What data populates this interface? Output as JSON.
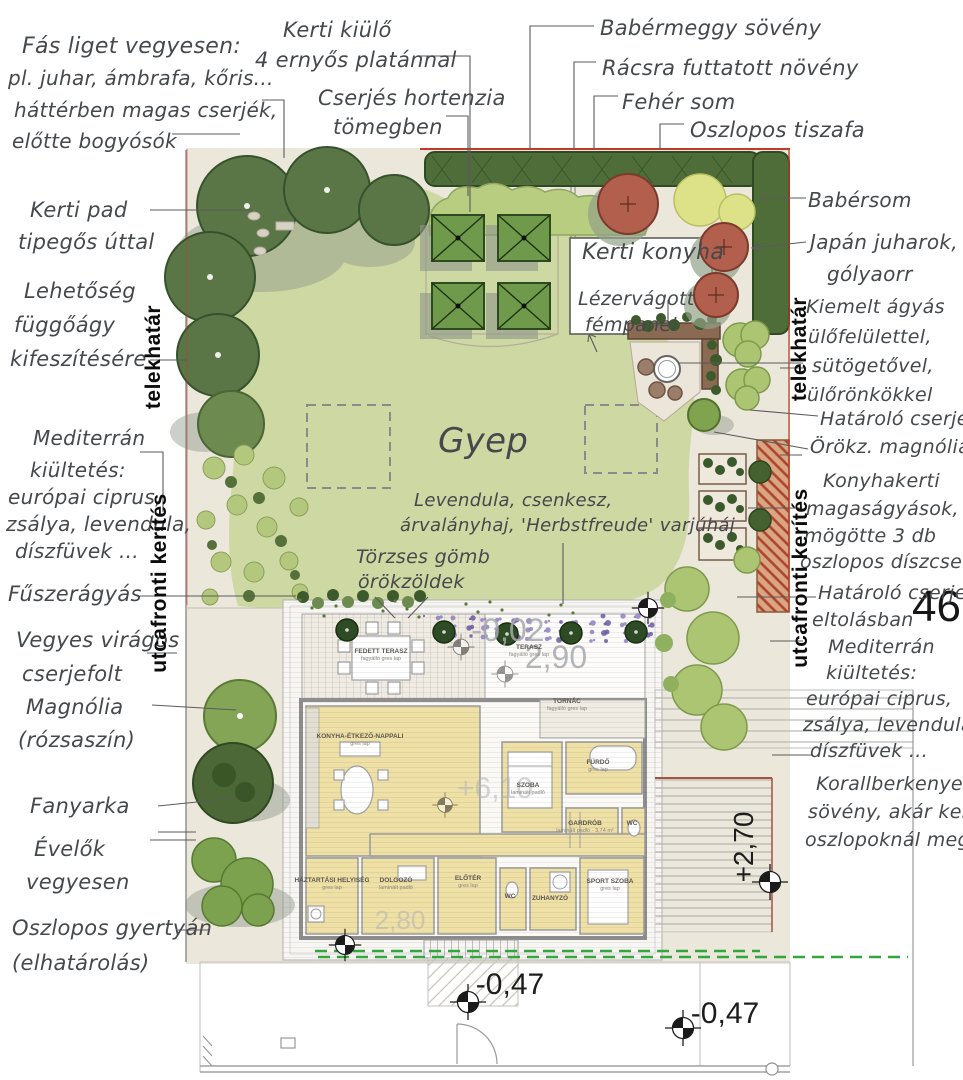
{
  "plot_number": "46",
  "palette": {
    "lawn": "#cdd8a2",
    "ground": "#ece7db",
    "hedge_dark": "#4f6d39",
    "shrub_light": "#abc573",
    "tree_dark": "#5b7646",
    "japanese_maple": "#b2604d",
    "boundary_red": "#c0392b",
    "room_yellow": "#efe0a5",
    "lavender": "#8d7fc0",
    "handwriting": "#45494c",
    "dashed_green": "#33a63c"
  },
  "handwritten_labels": [
    {
      "t": "Fás liget vegyesen:",
      "x": 22,
      "y": 36,
      "fs": 22
    },
    {
      "t": "pl. juhar, ámbrafa, kőris...",
      "x": 8,
      "y": 68,
      "fs": 20
    },
    {
      "t": "háttérben magas cserjék,",
      "x": 14,
      "y": 100,
      "fs": 20
    },
    {
      "t": "előtte bogyósók",
      "x": 12,
      "y": 131,
      "fs": 20
    },
    {
      "t": "Kerti pad",
      "x": 30,
      "y": 200,
      "fs": 21
    },
    {
      "t": "tipegős úttal",
      "x": 18,
      "y": 232,
      "fs": 21
    },
    {
      "t": "Lehetőség",
      "x": 24,
      "y": 281,
      "fs": 21
    },
    {
      "t": "függőágy",
      "x": 14,
      "y": 315,
      "fs": 21
    },
    {
      "t": "kifeszítésére",
      "x": 10,
      "y": 349,
      "fs": 21
    },
    {
      "t": "Mediterrán",
      "x": 33,
      "y": 428,
      "fs": 20
    },
    {
      "t": "kiültetés:",
      "x": 30,
      "y": 460,
      "fs": 20
    },
    {
      "t": "európai ciprus,",
      "x": 8,
      "y": 487,
      "fs": 20
    },
    {
      "t": "zsálya, levendula,",
      "x": 6,
      "y": 514,
      "fs": 20
    },
    {
      "t": "díszfüvek ...",
      "x": 15,
      "y": 541,
      "fs": 20
    },
    {
      "t": "Fűszerágyás",
      "x": 8,
      "y": 584,
      "fs": 21
    },
    {
      "t": "Vegyes virágos",
      "x": 16,
      "y": 630,
      "fs": 21
    },
    {
      "t": "cserjefolt",
      "x": 22,
      "y": 664,
      "fs": 21
    },
    {
      "t": "Magnólia",
      "x": 26,
      "y": 697,
      "fs": 21
    },
    {
      "t": "(rózsaszín)",
      "x": 18,
      "y": 730,
      "fs": 21
    },
    {
      "t": "Fanyarka",
      "x": 30,
      "y": 796,
      "fs": 21
    },
    {
      "t": "Évelők",
      "x": 34,
      "y": 839,
      "fs": 21
    },
    {
      "t": "vegyesen",
      "x": 26,
      "y": 872,
      "fs": 21
    },
    {
      "t": "Oszlopos gyertyán",
      "x": 12,
      "y": 918,
      "fs": 21
    },
    {
      "t": "(elhatárolás)",
      "x": 12,
      "y": 953,
      "fs": 21
    },
    {
      "t": "Kerti kiülő",
      "x": 283,
      "y": 20,
      "fs": 21
    },
    {
      "t": "4 ernyős platánnal",
      "x": 255,
      "y": 50,
      "fs": 21
    },
    {
      "t": "Cserjés hortenzia",
      "x": 318,
      "y": 88,
      "fs": 21
    },
    {
      "t": "tömegben",
      "x": 333,
      "y": 117,
      "fs": 21
    },
    {
      "t": "Babérmeggy sövény",
      "x": 600,
      "y": 18,
      "fs": 21
    },
    {
      "t": "Rácsra futtatott növény",
      "x": 602,
      "y": 58,
      "fs": 21
    },
    {
      "t": "Fehér som",
      "x": 622,
      "y": 92,
      "fs": 21
    },
    {
      "t": "Oszlopos tiszafa",
      "x": 690,
      "y": 120,
      "fs": 21
    },
    {
      "t": "Babérsom",
      "x": 808,
      "y": 190,
      "fs": 20
    },
    {
      "t": "Japán juharok,",
      "x": 810,
      "y": 232,
      "fs": 20
    },
    {
      "t": "gólyaorr",
      "x": 827,
      "y": 264,
      "fs": 20
    },
    {
      "t": "Kiemelt ágyás",
      "x": 806,
      "y": 298,
      "fs": 19
    },
    {
      "t": "ülőfelülettel,",
      "x": 808,
      "y": 328,
      "fs": 19
    },
    {
      "t": "sütögetővel,",
      "x": 812,
      "y": 357,
      "fs": 19
    },
    {
      "t": "ülőrönkökkel",
      "x": 807,
      "y": 386,
      "fs": 19
    },
    {
      "t": "Határoló cserje",
      "x": 820,
      "y": 410,
      "fs": 19
    },
    {
      "t": "Örökz. magnólia",
      "x": 810,
      "y": 438,
      "fs": 19
    },
    {
      "t": "Konyhakerti",
      "x": 823,
      "y": 472,
      "fs": 19
    },
    {
      "t": "magaságyások,",
      "x": 806,
      "y": 500,
      "fs": 19
    },
    {
      "t": "mögötte 3 db",
      "x": 804,
      "y": 527,
      "fs": 19
    },
    {
      "t": "oszlopos díszcser.",
      "x": 800,
      "y": 553,
      "fs": 19
    },
    {
      "t": "Határoló cserje",
      "x": 818,
      "y": 584,
      "fs": 19
    },
    {
      "t": "eltolásban",
      "x": 812,
      "y": 611,
      "fs": 19
    },
    {
      "t": "Mediterrán",
      "x": 828,
      "y": 638,
      "fs": 19
    },
    {
      "t": "kiültetés:",
      "x": 826,
      "y": 664,
      "fs": 19
    },
    {
      "t": "európai ciprus,",
      "x": 806,
      "y": 690,
      "fs": 19
    },
    {
      "t": "zsálya, levendula,",
      "x": 803,
      "y": 716,
      "fs": 19
    },
    {
      "t": "díszfüvek ...",
      "x": 810,
      "y": 742,
      "fs": 19
    },
    {
      "t": "Korallberkenye",
      "x": 816,
      "y": 775,
      "fs": 19
    },
    {
      "t": "sövény, akár kerítés-",
      "x": 808,
      "y": 803,
      "fs": 19
    },
    {
      "t": "oszlopoknál megtörve",
      "x": 805,
      "y": 831,
      "fs": 19
    },
    {
      "t": "Kerti konyha",
      "x": 582,
      "y": 242,
      "fs": 22
    },
    {
      "t": "Lézervágott",
      "x": 578,
      "y": 290,
      "fs": 19
    },
    {
      "t": "fémpanel",
      "x": 585,
      "y": 316,
      "fs": 19
    },
    {
      "t": "Gyep",
      "x": 438,
      "y": 424,
      "fs": 34
    },
    {
      "t": "Levendula, csenkesz,",
      "x": 414,
      "y": 492,
      "fs": 18
    },
    {
      "t": "árvalányhaj, 'Herbstfreude' varjúháj",
      "x": 400,
      "y": 517,
      "fs": 18
    },
    {
      "t": "Törzses gömb",
      "x": 356,
      "y": 548,
      "fs": 19
    },
    {
      "t": "örökzöldek",
      "x": 358,
      "y": 573,
      "fs": 19
    }
  ],
  "boundary_labels": [
    {
      "t": "telekhatár",
      "x": 154,
      "y": 357
    },
    {
      "t": "utcafronti kerítés",
      "x": 160,
      "y": 583
    },
    {
      "t": "telekhatár",
      "x": 800,
      "y": 349
    },
    {
      "t": "utcafronti kerítés",
      "x": 801,
      "y": 578
    }
  ],
  "elevations": [
    {
      "t": "-0,02",
      "x": 508,
      "y": 630,
      "fs": 32,
      "s": "faded"
    },
    {
      "t": "2,90",
      "x": 556,
      "y": 657,
      "fs": 32,
      "s": "faded"
    },
    {
      "t": "+6,10",
      "x": 495,
      "y": 789,
      "fs": 30,
      "s": "faded2"
    },
    {
      "t": "2,80",
      "x": 400,
      "y": 920,
      "fs": 26,
      "s": "faded2"
    },
    {
      "t": "+2,70",
      "x": 744,
      "y": 847,
      "fs": 28,
      "s": "dark",
      "rot": -90
    },
    {
      "t": "-0,47",
      "x": 510,
      "y": 985,
      "fs": 30,
      "s": "dark"
    },
    {
      "t": "-0,47",
      "x": 725,
      "y": 1014,
      "fs": 30,
      "s": "dark"
    }
  ],
  "room_labels": [
    {
      "t": "FEDETT TERASZ",
      "s": "fagyálló gres lap",
      "x": 381,
      "y": 655
    },
    {
      "t": "TERASZ",
      "s": "fagyálló gres lap",
      "x": 529,
      "y": 651
    },
    {
      "t": "TORNÁC",
      "s": "fagyálló gres lap",
      "x": 567,
      "y": 705
    },
    {
      "t": "KONYHA-ÉTKEZŐ-NAPPALI",
      "s": "gres lap",
      "x": 360,
      "y": 740
    },
    {
      "t": "SZOBA",
      "s": "laminált padló",
      "x": 528,
      "y": 789
    },
    {
      "t": "FÜRDŐ",
      "s": "gres lap",
      "x": 598,
      "y": 766
    },
    {
      "t": "GARDRÓB",
      "s": "laminált padló · 3,74 m²",
      "x": 585,
      "y": 827
    },
    {
      "t": "WC",
      "s": "",
      "x": 632,
      "y": 824
    },
    {
      "t": "HÁZTARTÁSI HELYISÉG",
      "s": "gres lap",
      "x": 332,
      "y": 884
    },
    {
      "t": "DOLGOZÓ",
      "s": "laminált padló",
      "x": 396,
      "y": 884
    },
    {
      "t": "ELŐTÉR",
      "s": "gres lap",
      "x": 468,
      "y": 882
    },
    {
      "t": "WC",
      "s": "",
      "x": 510,
      "y": 897
    },
    {
      "t": "ZUHANYZÓ",
      "s": "",
      "x": 550,
      "y": 899
    },
    {
      "t": "SPORT SZOBA",
      "s": "gres lap",
      "x": 610,
      "y": 885
    }
  ]
}
